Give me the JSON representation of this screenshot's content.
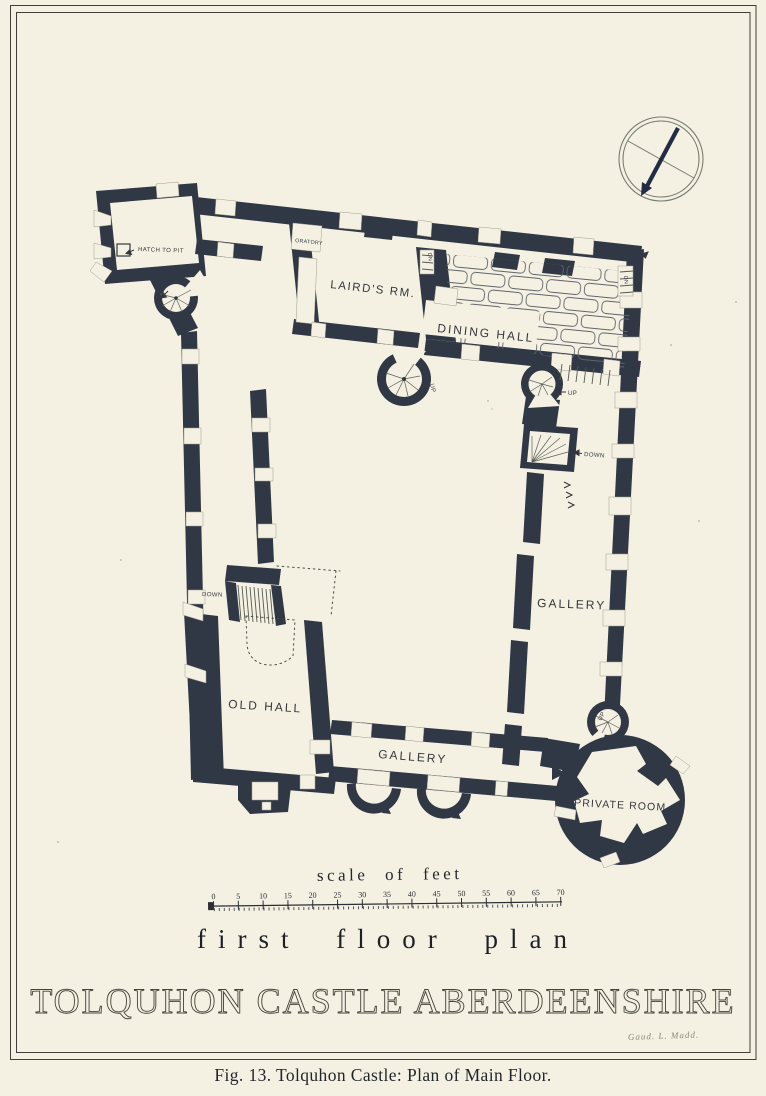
{
  "page": {
    "background": "#f4f1e3",
    "ink": "#313845",
    "frame_color": "#3f3f37",
    "needle_color": "#222c45"
  },
  "plan": {
    "labels": {
      "hatch_to_pit": "HATCH TO PIT",
      "oratory": "ORATORY",
      "lairds_room": "LAIRD'S RM.",
      "dining_hall": "DINING HALL",
      "gallery_east": "GALLERY",
      "gallery_south": "GALLERY",
      "old_hall": "OLD HALL",
      "private_room": "PRIVATE ROOM",
      "up": "UP",
      "down": "DOWN",
      "dn": "DN"
    }
  },
  "scale_bar": {
    "title": "scale of feet",
    "ticks": [
      "0",
      "5",
      "10",
      "15",
      "20",
      "25",
      "30",
      "35",
      "40",
      "45",
      "50",
      "55",
      "60",
      "65",
      "70"
    ]
  },
  "titles": {
    "floor": "first floor plan",
    "main": "TOLQUHON CASTLE ABERDEENSHIRE"
  },
  "caption": "Fig. 13. Tolquhon Castle: Plan of Main Floor.",
  "signature": "Gaud. L. Madd."
}
